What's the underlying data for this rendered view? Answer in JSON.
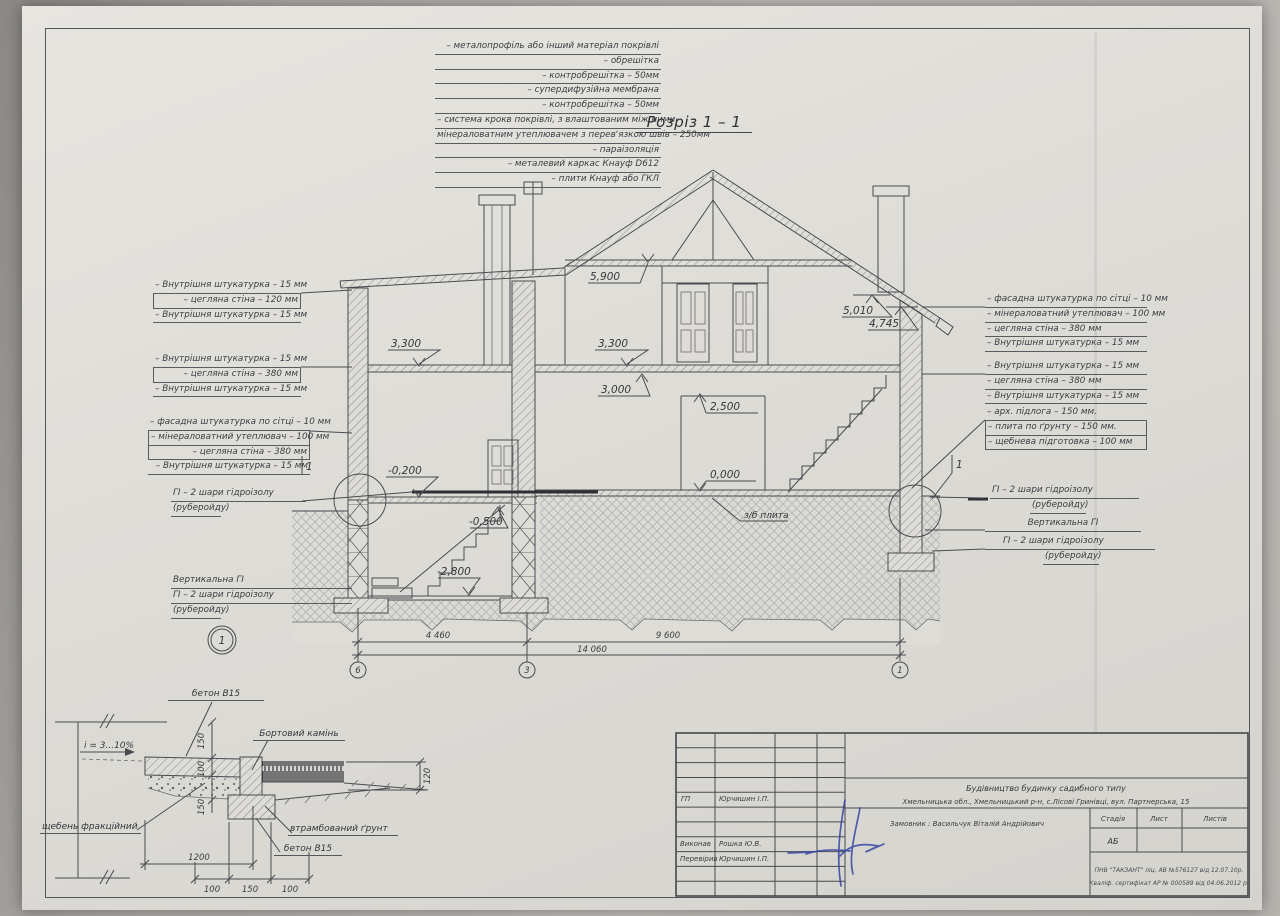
{
  "title": "Розріз 1 – 1",
  "roof_layers": [
    "– металопрофіль або інший матеріал покрівлі",
    "– обрешітка",
    "– контробрешітка – 50мм",
    "– супердифузійна мембрана",
    "– контробрешітка – 50мм",
    "– система крокв покрівлі, з влаштованим між ними",
    "мінераловатним утеплювачем з перев'язкою швів – 250мм",
    "– параізоляція",
    "– металевий каркас Кнауф D612",
    "– плити Кнауф або ГКЛ"
  ],
  "stacks": {
    "left_upper": [
      "– Внутрішня штукатурка – 15 мм",
      "– цегляна стіна – 120 мм",
      "– Внутрішня штукатурка – 15 мм"
    ],
    "left_mid": [
      "– Внутрішня штукатурка – 15 мм",
      "– цегляна стіна – 380 мм",
      "– Внутрішня штукатурка – 15 мм"
    ],
    "left_lower": [
      "– фасадна штукатурка по сітці – 10 мм",
      "– мінераловатний утеплювач – 100 мм",
      "– цегляна стіна – 380 мм",
      "– Внутрішня штукатурка – 15 мм"
    ],
    "right_upper": [
      "– фасадна штукатурка по сітці – 10 мм",
      "– мінераловатний утеплювач – 100 мм",
      "– цегляна стіна – 380 мм",
      "– Внутрішня штукатурка – 15 мм"
    ],
    "right_mid": [
      "– Внутрішня штукатурка – 15 мм",
      "– цегляна стіна – 380 мм",
      "– Внутрішня штукатурка – 15 мм"
    ],
    "right_floor": [
      "– арх. підлога – 150 мм.",
      "– плита по ґрунту – 150 мм.",
      "– щебнева підготовка – 100 мм"
    ]
  },
  "gi": {
    "line1": "ГІ – 2 шари гідроізолу",
    "line2": "(руберойду)",
    "vertical": "Вертикальна ГІ"
  },
  "elevations": {
    "attic": "5,900",
    "eave_high": "5,010",
    "eave_low": "4,745",
    "floor2_left": "3,300",
    "floor2_right": "3,300",
    "ceiling1": "3,000",
    "lintel": "2,500",
    "zero": "0,000",
    "minus_02": "-0,200",
    "minus_05": "-0,500",
    "minus_28": "-2,800"
  },
  "slab_label": "з/б плита",
  "dims": {
    "span_left": "4 460",
    "span_right": "9 600",
    "total": "14 060"
  },
  "axes": {
    "left": "6",
    "middle": "3",
    "right": "1"
  },
  "detail_callout": "1",
  "detail_flag": "1",
  "detail": {
    "labels": {
      "concrete_top": "бетон В15",
      "curb": "Бортовий камінь",
      "slope": "i = 3...10%",
      "gravel": "щебень фракційний",
      "soil": "втрамбований ґрунт",
      "concrete_bottom": "бетон В15"
    },
    "dims": {
      "v_top": "150",
      "v_mid": "100",
      "v_bot": "150",
      "v_right": "120",
      "width": "1200",
      "b_left": "100",
      "b_mid": "150",
      "b_right": "100"
    }
  },
  "titleblock": {
    "gp_label": "ГП",
    "gp_name": "Юрчишин І.П.",
    "made_label": "Виконав",
    "made_name": "Рошка Ю.В.",
    "checked_label": "Перевірив",
    "checked_name": "Юрчишин І.П.",
    "project_type": "Будівництво будинку садибного типу",
    "project_address": "Хмельницька обл.,  Хмельницький р-н, с.Лісові Гринівці, вул. Партнерська, 15",
    "client": "Замовник : Васильчук Віталій Андрійович",
    "stage_label": "Стадія",
    "sheet_label": "Лист",
    "sheets_label": "Листів",
    "stage_value": "АБ",
    "license_line1": "ПНВ \"ТАКЗАНТ\" ліц. АВ №576127 від 12.07.10р.",
    "license_line2": "Кваліф. сертифікат АР № 000589 від 04.06.2012 р."
  }
}
